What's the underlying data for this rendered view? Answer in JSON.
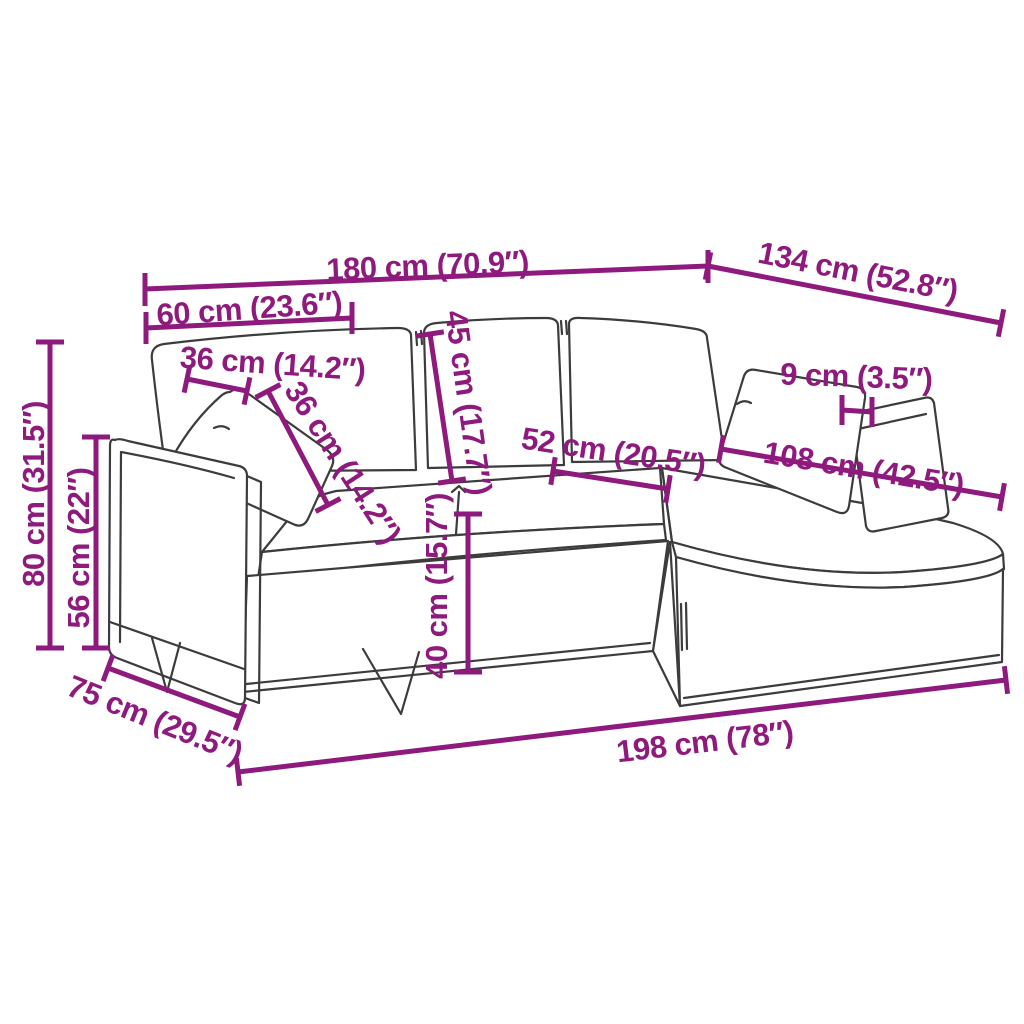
{
  "diagram": {
    "kind": "product-dimension-diagram",
    "subject": "L-shaped 3-seater sofa with chaise longue (line drawing)",
    "accent_color": "#8e1a7d",
    "line_color": "#3c3c3c",
    "background_color": "#ffffff",
    "units": [
      "cm",
      "inch"
    ]
  },
  "dims": {
    "back_width": {
      "label": "180 cm (70.9″)",
      "cm": 180,
      "inch": 70.9,
      "meaning": "total width along the back"
    },
    "chaise_depth": {
      "label": "134 cm (52.8″)",
      "cm": 134,
      "inch": 52.8,
      "meaning": "chaise section length"
    },
    "left_module_width": {
      "label": "60 cm (23.6″)",
      "cm": 60,
      "inch": 23.6,
      "meaning": "armrest module width"
    },
    "pillow_width": {
      "label": "36 cm (14.2″)",
      "cm": 36,
      "inch": 14.2,
      "meaning": "pillow width"
    },
    "pillow_height": {
      "label": "36 cm (14.2″)",
      "cm": 36,
      "inch": 14.2,
      "meaning": "pillow height"
    },
    "backrest_height": {
      "label": "45 cm (17.7″)",
      "cm": 45,
      "inch": 17.7,
      "meaning": "back cushion height"
    },
    "cushion_thickness": {
      "label": "9 cm (3.5″)",
      "cm": 9,
      "inch": 3.5,
      "meaning": "cushion thickness"
    },
    "seat_depth": {
      "label": "52 cm (20.5″)",
      "cm": 52,
      "inch": 20.5,
      "meaning": "seat depth"
    },
    "chaise_seat_length": {
      "label": "108 cm (42.5″)",
      "cm": 108,
      "inch": 42.5,
      "meaning": "chaise seat length"
    },
    "total_height": {
      "label": "80 cm (31.5″)",
      "cm": 80,
      "inch": 31.5,
      "meaning": "total height"
    },
    "armrest_height": {
      "label": "56 cm (22″)",
      "cm": 56,
      "inch": 22,
      "meaning": "armrest height"
    },
    "seat_height": {
      "label": "40 cm (15.7″)",
      "cm": 40,
      "inch": 15.7,
      "meaning": "seat height from floor"
    },
    "body_depth": {
      "label": "75 cm (29.5″)",
      "cm": 75,
      "inch": 29.5,
      "meaning": "sofa body depth"
    },
    "front_length": {
      "label": "198 cm (78″)",
      "cm": 198,
      "inch": 78,
      "meaning": "total front length"
    }
  }
}
